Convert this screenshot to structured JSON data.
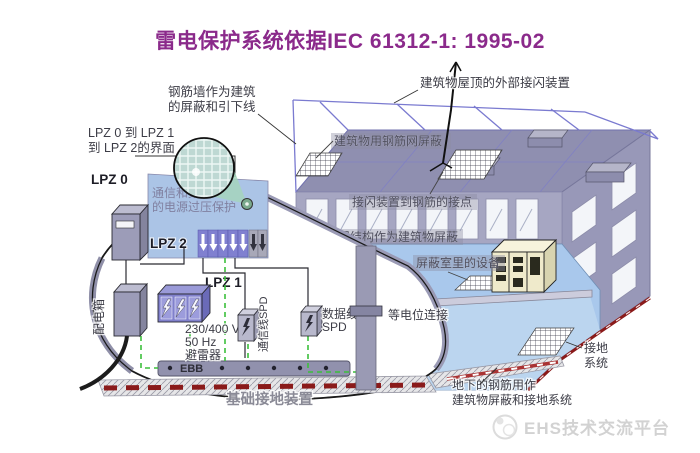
{
  "title": "雷电保护系统依据IEC 61312-1: 1995-02",
  "labels": {
    "rebar_wall_1": "钢筋墙作为建筑",
    "rebar_wall_2": "的屏蔽和引下线",
    "roof_air_termination": "建筑物屋顶的外部接闪装置",
    "roof_mesh_shield": "建筑物用钢筋网屏蔽",
    "lpz_interface_1": "LPZ 0 到 LPZ 1",
    "lpz_interface_2": "到 LPZ 2的界面",
    "lpz0": "LPZ 0",
    "comm_surge_1": "通信和数据",
    "comm_surge_2": "的电源过压保护",
    "lpz2": "LPZ 2",
    "lpz1": "LPZ 1",
    "air_term_rebar_joint": "接闪装置到钢筋的接点",
    "metal_structure_shield": "金属结构作为建筑物屏蔽",
    "shielded_room": "屏蔽室里的设备",
    "distribution_box": "配电箱",
    "arrester_1": "230/400 V",
    "arrester_2": "50 Hz",
    "arrester_3": "避雷器",
    "comm_line_spd": "通信线SPD",
    "data_line_spd_1": "数据线",
    "data_line_spd_2": "SPD",
    "equipotential_bonding": "等电位连接",
    "ebb": "EBB",
    "foundation_earthing": "基础接地装置",
    "underground_rebar_1": "地下的钢筋用作",
    "underground_rebar_2": "建筑物屏蔽和接地系统",
    "earthing_system_1": "接地",
    "earthing_system_2": "系统"
  },
  "watermark": {
    "text": "EHS技术交流平台"
  },
  "colors": {
    "title": "#8B2A8B",
    "accent_green": "#3CBF3C",
    "earth_red": "#8A1A1A",
    "spd_purple": "#8080D0",
    "building_gray": "#9A9ABA",
    "interior_blue": "#A9C8EC"
  }
}
